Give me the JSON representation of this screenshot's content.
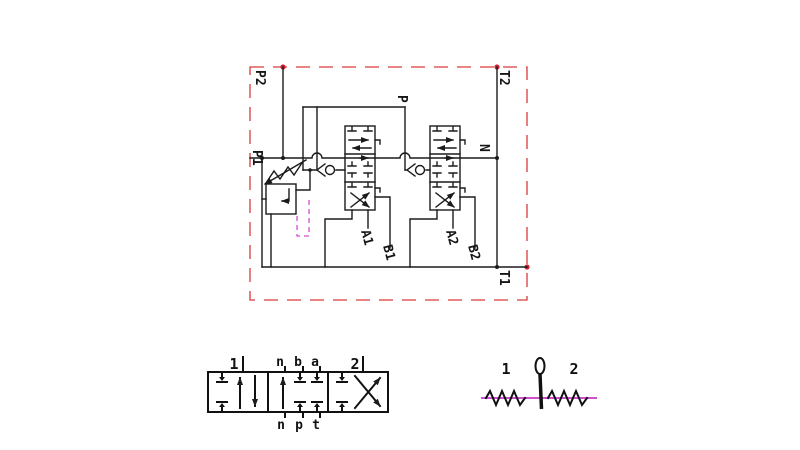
{
  "circuit": {
    "port_labels": {
      "p2": "P2",
      "t2": "T2",
      "p1": "P1",
      "n": "N",
      "t1": "T1",
      "p": "P"
    },
    "work_port_labels": {
      "a1": "A1",
      "b1": "B1",
      "a2": "A2",
      "b2": "B2"
    }
  },
  "spool_symbol": {
    "top_labels": [
      "1",
      "n",
      "b",
      "a",
      "2"
    ],
    "bottom_labels": [
      "n",
      "p",
      "t"
    ]
  },
  "lever_symbol": {
    "labels": [
      "1",
      "2"
    ]
  },
  "colors": {
    "boundary_red": "#d93b3b",
    "pilot_magenta": "#cf4fcf",
    "line_black": "#1b1b1b",
    "background": "#ffffff"
  }
}
